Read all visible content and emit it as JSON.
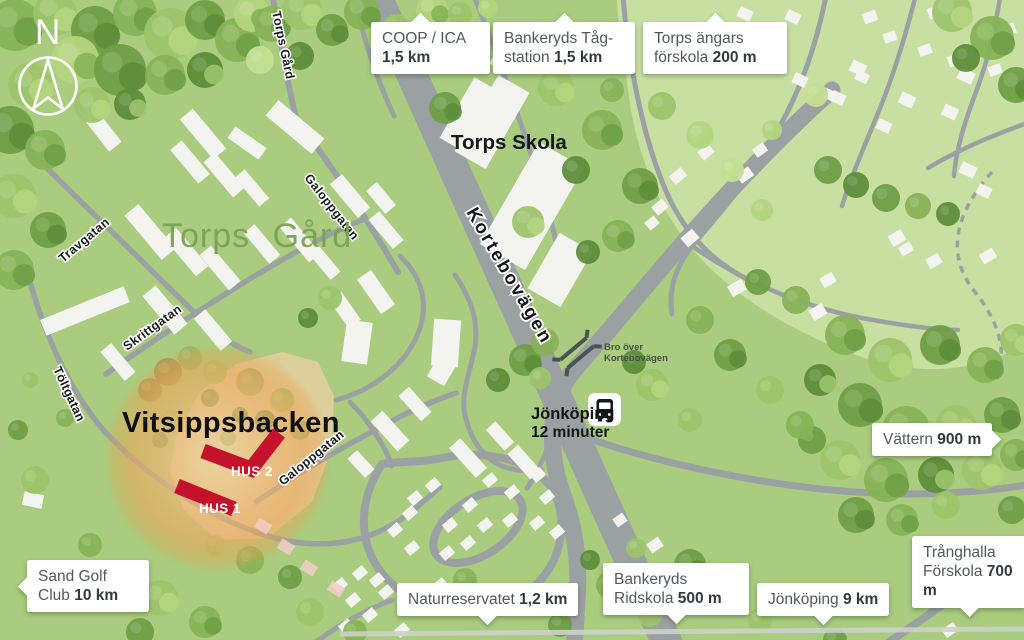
{
  "map": {
    "compass_label": "N",
    "area_label": "Torps Gård",
    "site_label": "Vitsippsbacken",
    "school_label": "Torps Skola",
    "hus2_label": "HUS 2",
    "hus1_label": "HUS 1",
    "bus_stop": {
      "line1": "Jönköping",
      "line2": "12 minuter"
    },
    "bridge": {
      "line1": "Bro över",
      "line2": "Kortebovägen"
    },
    "streets": {
      "torps_gard_road": "Torps Gård",
      "galoppgatan_upper": "Galoppgatan",
      "travgatan": "Travgatan",
      "skrittgatan": "Skrittgatan",
      "toltgatan": "Töltgatan",
      "galoppgatan_lower": "Galoppgatan",
      "kortebovagen": "Kortebovägen"
    },
    "colors": {
      "map_green": "#a9cc7e",
      "light_green": "#c8dfa2",
      "road_gray": "#9ba1a3",
      "building_white": "#f3f3f0",
      "accent_red": "#c4122d",
      "glow_orange": "#eda75e",
      "label_green": "#7ba155"
    }
  },
  "callouts": [
    {
      "name": "COOP / ICA",
      "distance": "1,5 km"
    },
    {
      "name": "Bankeryds Tåg-station",
      "distance": "1,5 km"
    },
    {
      "name": "Torps ängars förskola",
      "distance": "200 m"
    },
    {
      "name": "Vättern",
      "distance": "900 m"
    },
    {
      "name": "Sand Golf Club",
      "distance": "10 km"
    },
    {
      "name": "Naturreservatet",
      "distance": "1,2 km"
    },
    {
      "name": "Bankeryds Ridskola",
      "distance": "500 m"
    },
    {
      "name": "Jönköping",
      "distance": "9 km"
    },
    {
      "name": "Trånghalla Förskola",
      "distance": "700 m"
    }
  ]
}
